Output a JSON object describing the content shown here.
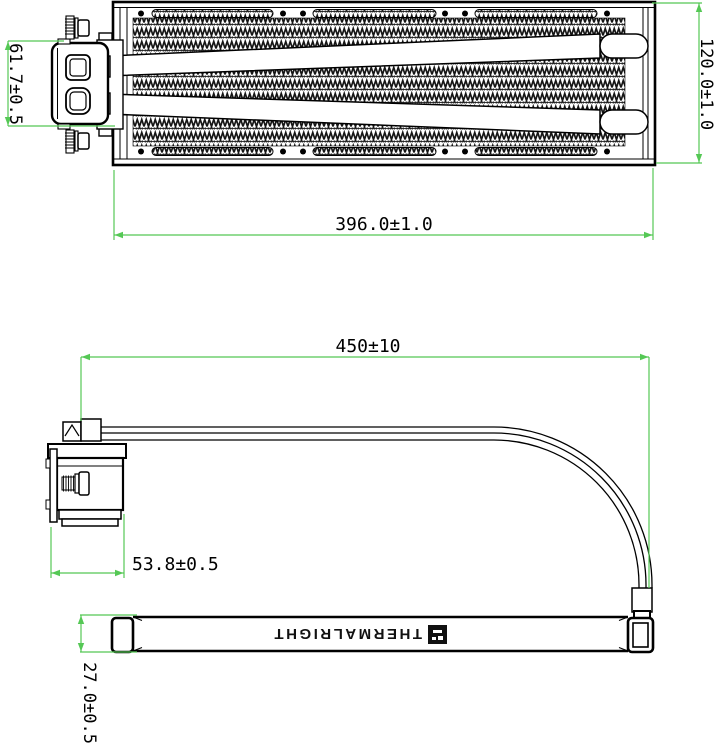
{
  "drawing_title": "AIO liquid cooler dimensional drawing",
  "brand": {
    "label": "THERMALRIGHT"
  },
  "colors": {
    "dimension": "#55c855",
    "ink": "#000000",
    "background": "#ffffff"
  },
  "dims": {
    "pump_height": "61.7±0.5",
    "radiator_width": "120.0±1.0",
    "radiator_length": "396.0±1.0",
    "tube_length": "450±10",
    "pump_depth": "53.8±0.5",
    "radiator_thickness": "27.0±0.5"
  }
}
